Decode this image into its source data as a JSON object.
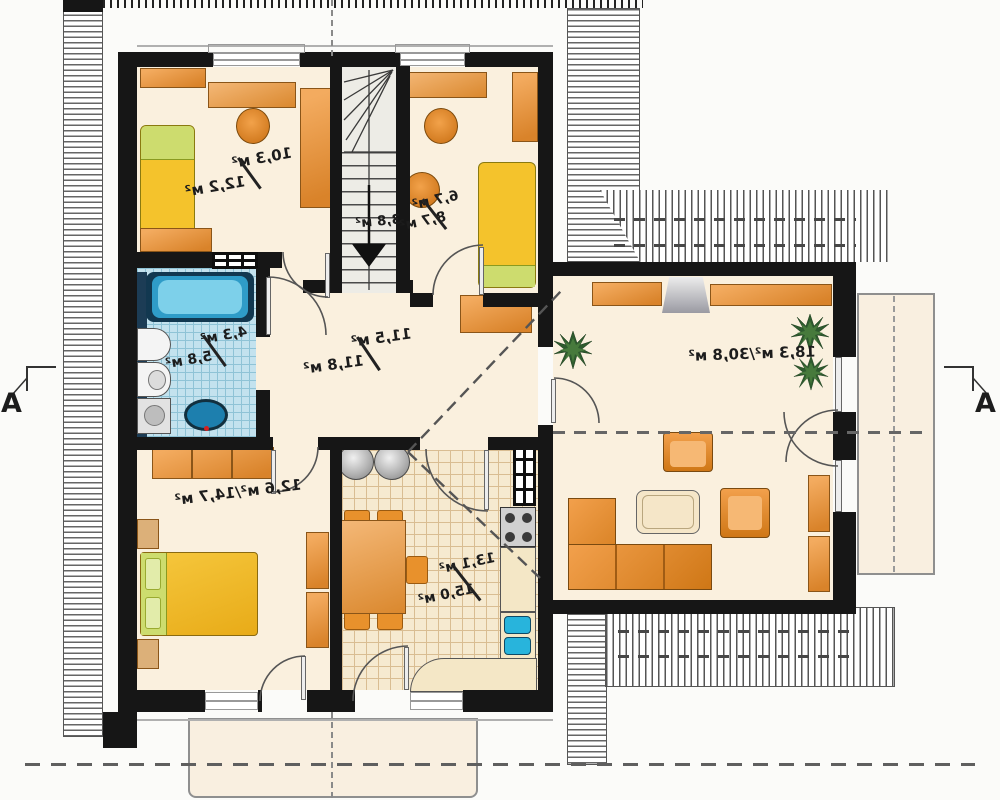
{
  "plan": {
    "title": "first-floor-plan-mirrored",
    "section_markers": {
      "left": "A",
      "right": "A"
    },
    "rooms": {
      "bedroom_top_left": {
        "area": "10,3 м²",
        "area_total": "12,2 м²"
      },
      "staircase": {
        "area": "3,8 м²"
      },
      "bedroom_top_right": {
        "area": "6,7 м²",
        "area_total": "8,7 м²"
      },
      "bathroom": {
        "area": "4,3 м²",
        "area_total": "5,8 м²"
      },
      "hall": {
        "area": "11,5 м²",
        "area_total": "11,8 м²"
      },
      "bedroom_bottom_left": {
        "area_combined": "12,6 м²/14,7 м²"
      },
      "kitchen_dining": {
        "area": "13,1 м²",
        "area_total": "15,0 м²"
      },
      "living_room": {
        "area_combined": "18,3 м²/30,8 м²"
      }
    },
    "colors": {
      "wall": "#161616",
      "floor": "#faf0de",
      "furniture_orange": "#e8913c",
      "bed_yellow": "#f4c32c",
      "bed_green": "#cddc6e",
      "bath_blue": "#35aad6",
      "tile_blue": "#c3e2ee",
      "roof_outline": "#555555"
    }
  }
}
